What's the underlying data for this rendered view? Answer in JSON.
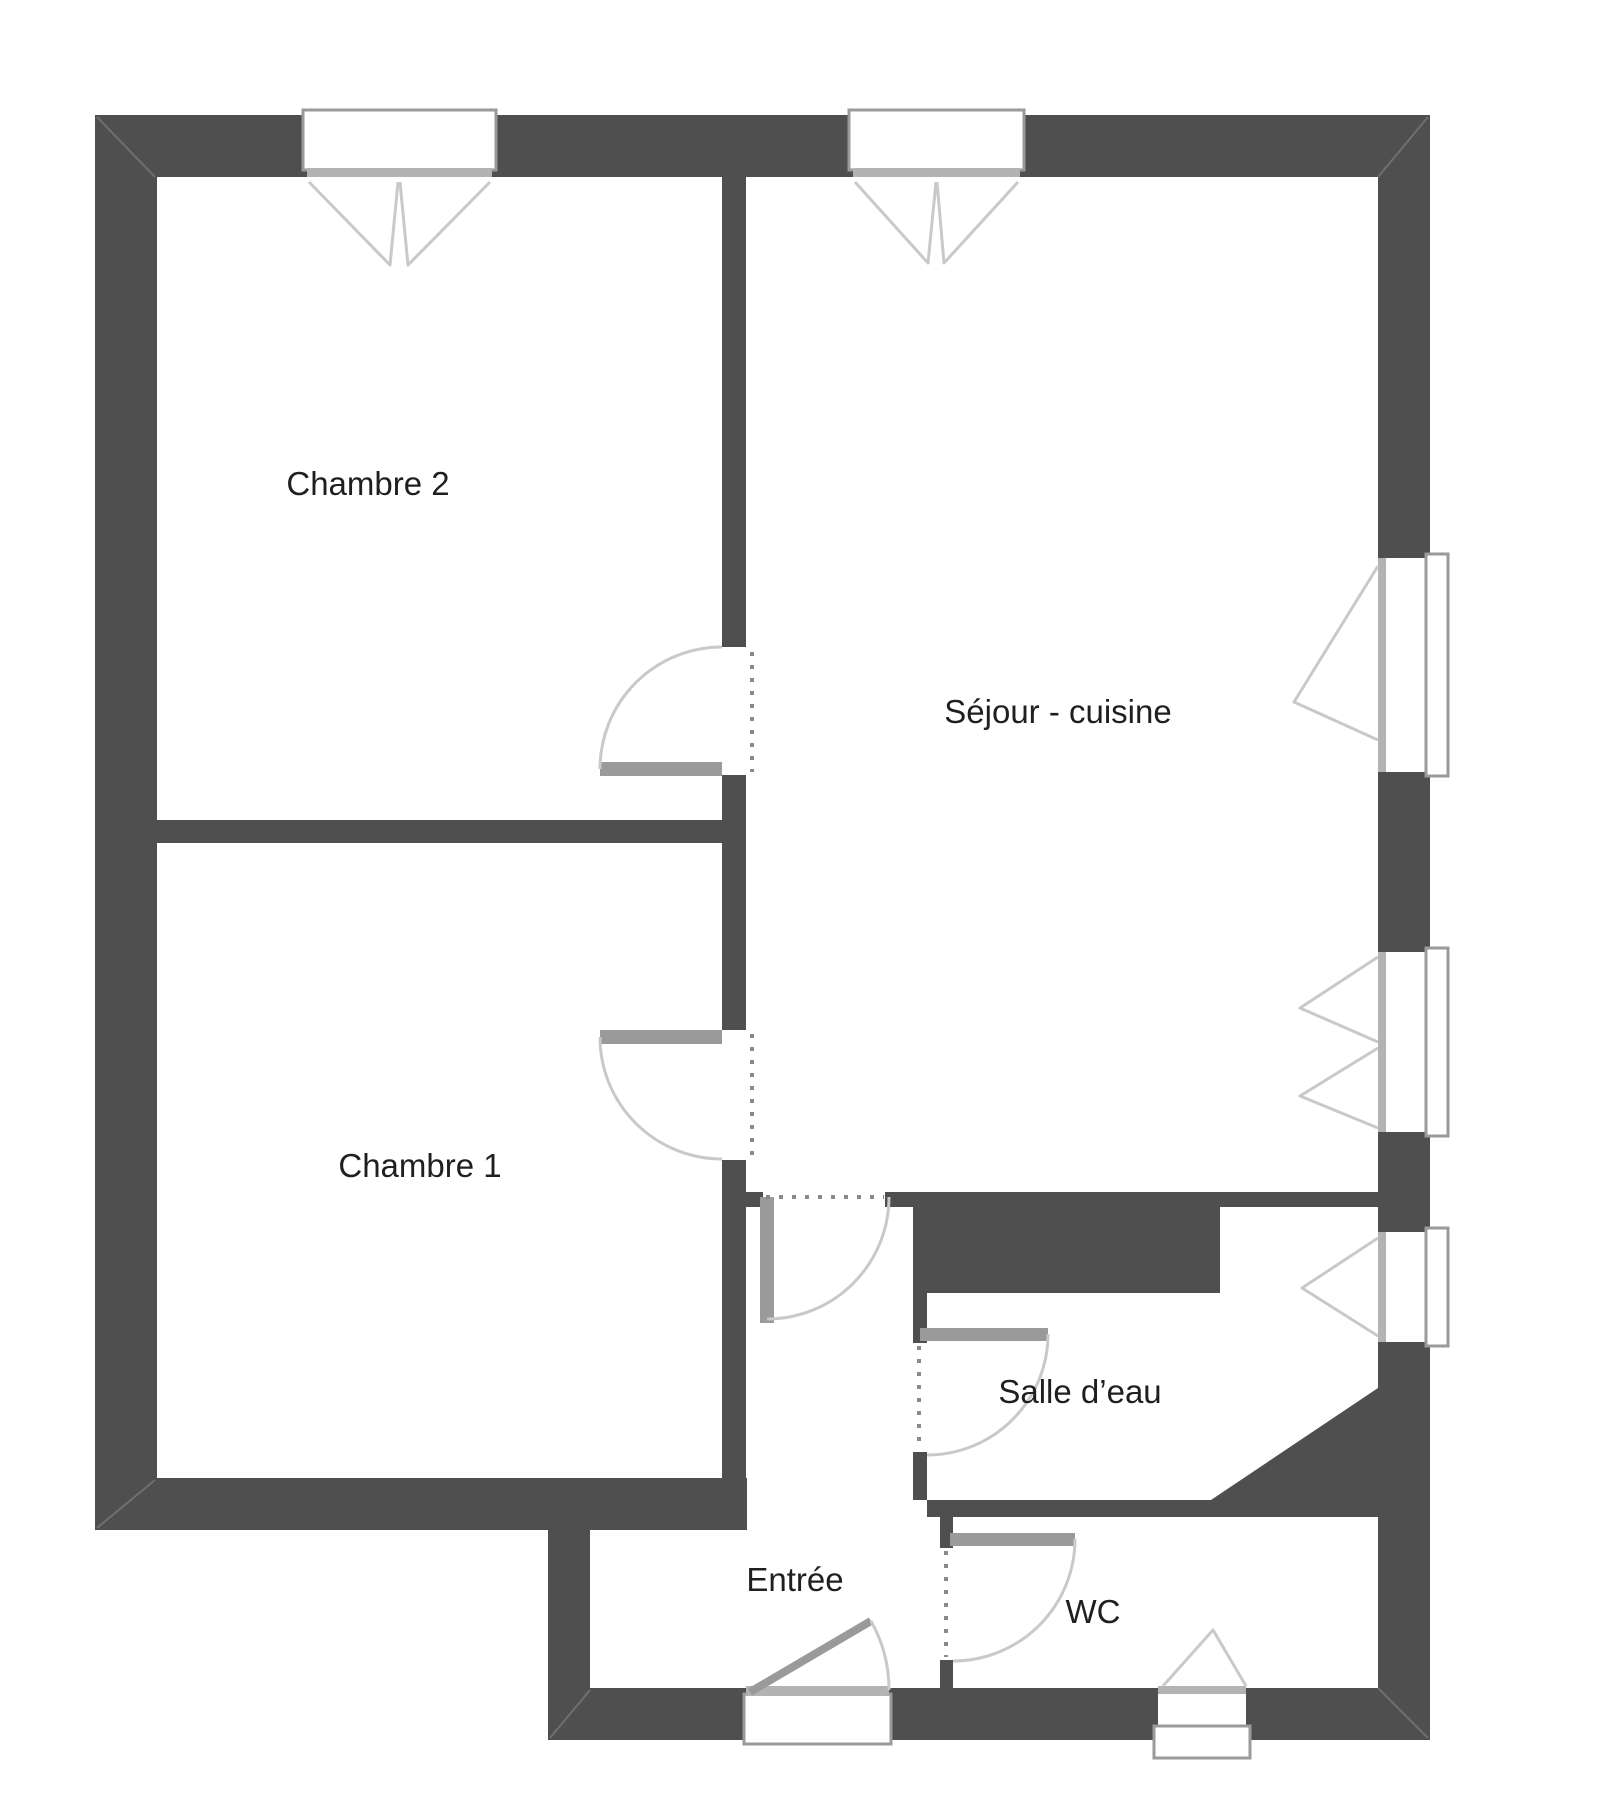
{
  "title": "Plan d'appartement",
  "colors": {
    "wall": "#4f4f4f",
    "frame": "#9a9a9a",
    "swing": "#c9c9c9",
    "dash": "#8a8a8a",
    "text": "#1f1f1f",
    "background": "#ffffff"
  },
  "rooms": [
    {
      "id": "chambre2",
      "label": "Chambre 2"
    },
    {
      "id": "chambre1",
      "label": "Chambre 1"
    },
    {
      "id": "sejour",
      "label": "Séjour - cuisine"
    },
    {
      "id": "salle_deau",
      "label": "Salle d’eau"
    },
    {
      "id": "entree",
      "label": "Entrée"
    },
    {
      "id": "wc",
      "label": "WC"
    }
  ]
}
